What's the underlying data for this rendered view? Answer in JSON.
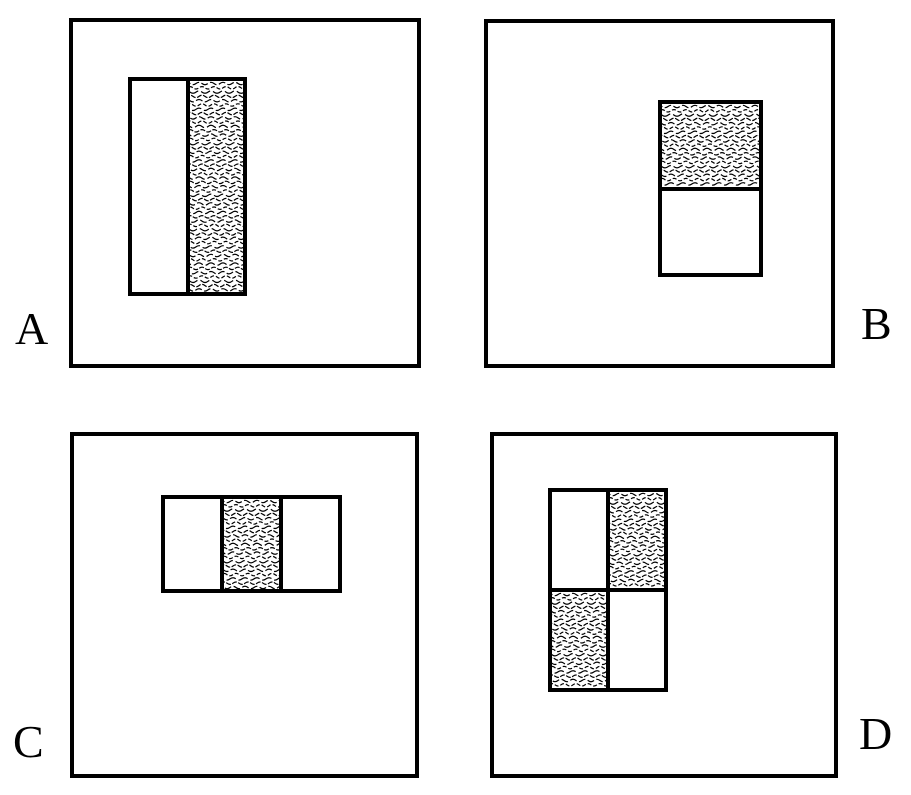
{
  "figure": {
    "background_color": "#ffffff",
    "ink_color": "#000000",
    "texture_name": "wavy-stipple-shading"
  },
  "panels": [
    {
      "label": "A",
      "layout": "two-vertical-halves",
      "cells": [
        "plain",
        "shaded"
      ]
    },
    {
      "label": "B",
      "layout": "two-horizontal-halves",
      "cells": [
        "shaded",
        "plain"
      ]
    },
    {
      "label": "C",
      "layout": "three-vertical-thirds",
      "cells": [
        "plain",
        "shaded",
        "plain"
      ]
    },
    {
      "label": "D",
      "layout": "grid-2x2",
      "cells": [
        "plain",
        "shaded",
        "shaded",
        "plain"
      ]
    }
  ]
}
